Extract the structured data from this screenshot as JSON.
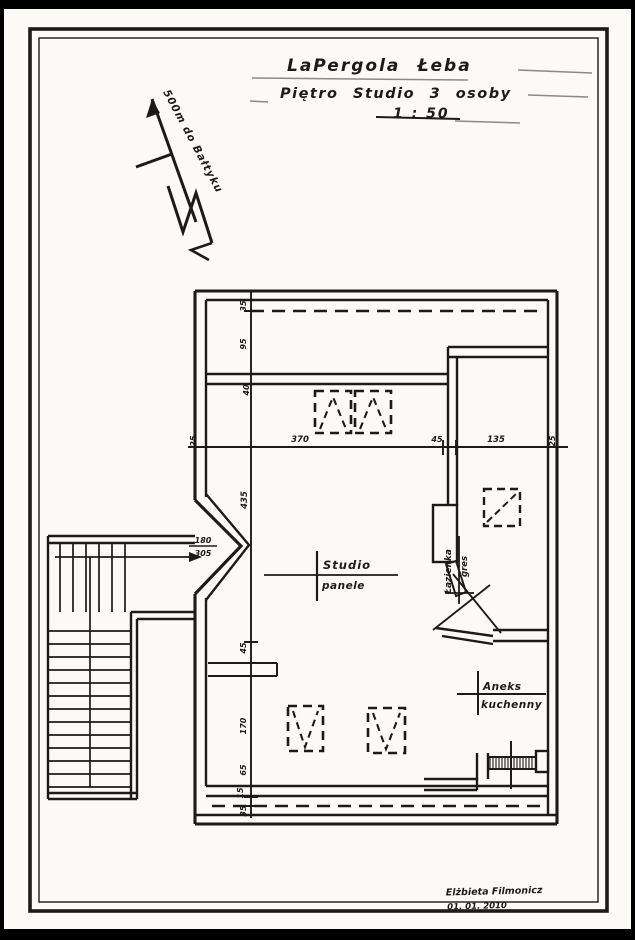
{
  "title": {
    "line1": "LaPergola Łeba",
    "line2": "Piętro Studio 3 osoby",
    "scale": "1 : 50"
  },
  "north": {
    "label": "500m do Bałtyku"
  },
  "plan": {
    "labels": {
      "studio": {
        "name": "Studio",
        "finish": "panele"
      },
      "bathroom": {
        "name": "Łazienka",
        "finish": "gres"
      },
      "kitchen": {
        "line1": "Aneks",
        "line2": "kuchenny"
      }
    },
    "dims": {
      "horizontal": [
        "25",
        "370",
        "45",
        "135",
        "25"
      ],
      "vertical": [
        "35",
        "95",
        "40",
        "435",
        "45",
        "170",
        "65",
        "15",
        "35"
      ],
      "entry": {
        "top": "180",
        "bottom": "305"
      }
    }
  },
  "signature": {
    "name": "Elżbieta Filmonicz",
    "date": "01. 01. 2010"
  },
  "colors": {
    "ink": "#1e1a16",
    "paper": "#fbfaf7",
    "scan_edge": "#000000"
  }
}
